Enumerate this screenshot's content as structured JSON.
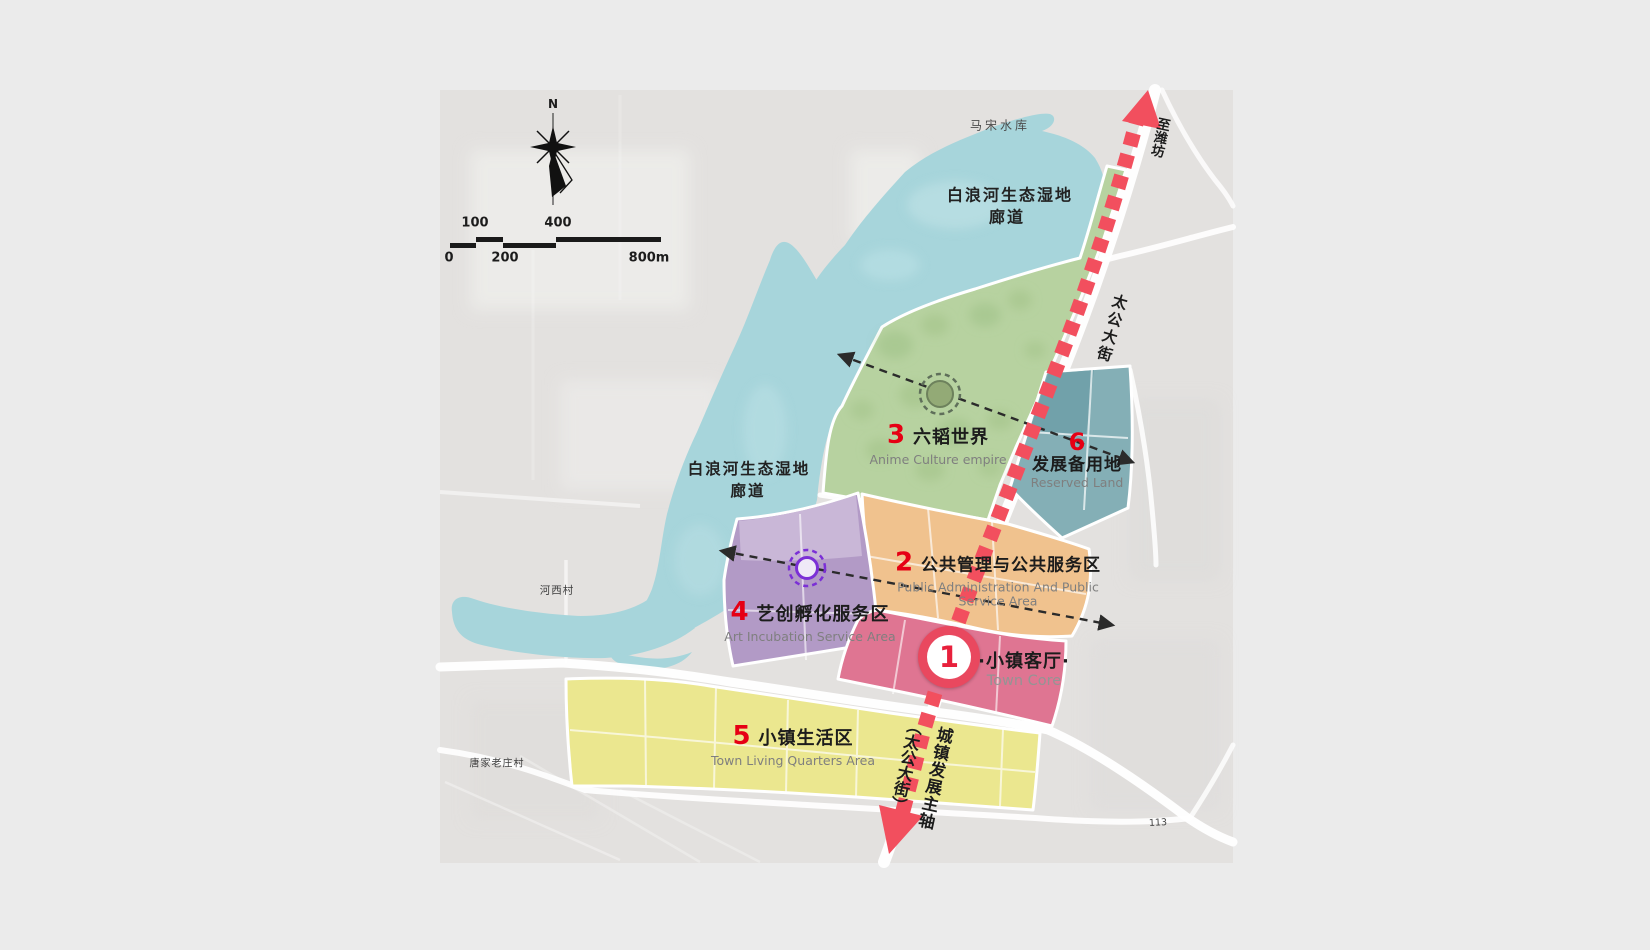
{
  "colors": {
    "page_bg": "#ebebeb",
    "map_bg": "#e3e1df",
    "water": "#a7d5db",
    "road": "#ffffff",
    "axis_red": "#f24f5e",
    "number_red": "#e60014",
    "title_black": "#1c1c1c",
    "subtitle_gray": "#7f7f7f"
  },
  "compass": {
    "north_label": "N"
  },
  "scale_bar": {
    "labels_top": [
      "100",
      "400"
    ],
    "labels_bottom": [
      "0",
      "200",
      "800m"
    ]
  },
  "places": {
    "reservoir": "马宋水库",
    "wetland_corridor_line1": "白浪河生态湿地",
    "wetland_corridor_line2": "廊道",
    "village_hexi": "河西村",
    "village_tangjialaozhuang": "唐家老庄村",
    "road_taigong_street": "太公大街",
    "to_weifang": "至潍坊",
    "axis_name": "城镇发展主轴",
    "axis_road": "（太公大街）",
    "road_113": "113"
  },
  "zones": {
    "z1": {
      "number": "1",
      "title": "·小镇客厅·",
      "subtitle": "Town Core",
      "color": "#df7592"
    },
    "z2": {
      "number": "2",
      "title": "公共管理与公共服务区",
      "subtitle_line1": "Public Administration And Public",
      "subtitle_line2": "Service Area",
      "color": "#f0c28e"
    },
    "z3": {
      "number": "3",
      "title": "六韬世界",
      "subtitle": "Anime Culture empire",
      "color": "#b7d2a0"
    },
    "z4": {
      "number": "4",
      "title": "艺创孵化服务区",
      "subtitle": "Art Incubation Service Area",
      "color": "#b29ac6"
    },
    "z5": {
      "number": "5",
      "title": "小镇生活区",
      "subtitle": "Town Living Quarters Area",
      "color": "#ebe78f"
    },
    "z6": {
      "number": "6",
      "title": "发展备用地",
      "subtitle": "Reserved Land",
      "color": "#84afb6"
    }
  }
}
